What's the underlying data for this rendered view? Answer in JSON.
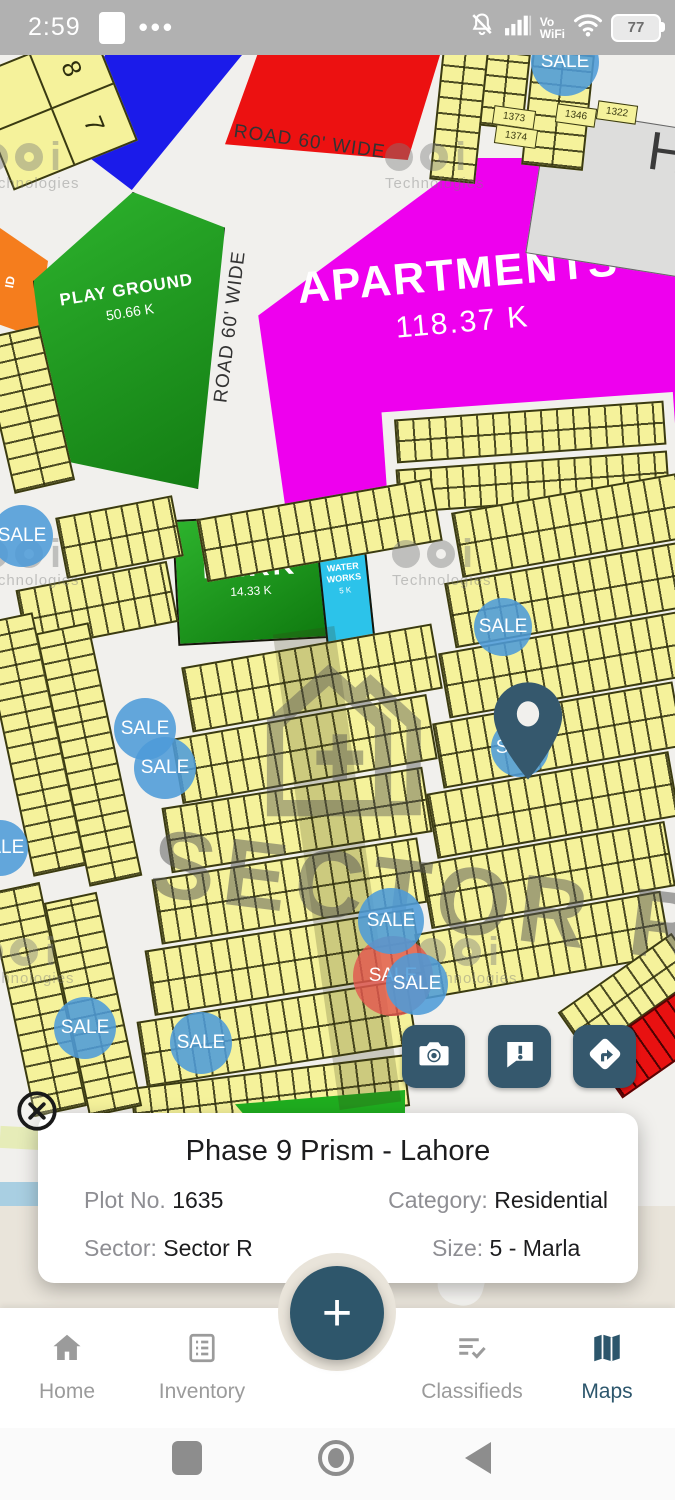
{
  "status_bar": {
    "time": "2:59",
    "menu_dots": "•••",
    "volte_line1": "Vo",
    "volte_line2": "WiFi",
    "battery": "77"
  },
  "map": {
    "sale_label": "SALE",
    "road_label_top": "ROAD 60' WIDE",
    "road_label_left": "ROAD 60' WIDE",
    "playground_name": "PLAY GROUND",
    "playground_size": "50.66 K",
    "apartments_name": "APARTMENTS",
    "apartments_size": "118.37 K",
    "park_name": "PARK",
    "park_size": "14.33 K",
    "waterworks_name": "WATER WORKS",
    "waterworks_size": "5 K",
    "sector_watermark": "SECTOR R",
    "brand_watermark": "Technologies",
    "building_label": "H",
    "orange_fragment": "ID",
    "block_numbers": [
      "7",
      "8"
    ],
    "plot_numbers": [
      "1373",
      "1374",
      "1346",
      "1322",
      "1433",
      "1431",
      "1472",
      "1474",
      "1764",
      "1807",
      "1808",
      "3334",
      "3337",
      "1859"
    ]
  },
  "info_card": {
    "title": "Phase 9 Prism - Lahore",
    "plot_label": "Plot No.",
    "plot_value": "1635",
    "category_label": "Category:",
    "category_value": "Residential",
    "sector_label": "Sector:",
    "sector_value": "Sector R",
    "size_label": "Size:",
    "size_value": "5 - Marla"
  },
  "fab_label": "+",
  "bottom_nav": {
    "items": [
      "Home",
      "Inventory",
      "Classifieds",
      "Maps"
    ],
    "active": "Maps"
  },
  "colors": {
    "accent_teal": "#2e566b",
    "sale_blue": "#4d9bd8",
    "sale_red": "#e2574e",
    "apartments_magenta": "#ee00ee",
    "park_green": "#1f9e1f",
    "water_cyan": "#2cc3ea",
    "plot_yellow": "#f5f29b",
    "zone_red": "#ec1111",
    "zone_blue": "#1b1bea",
    "zone_orange": "#f57d1d"
  }
}
